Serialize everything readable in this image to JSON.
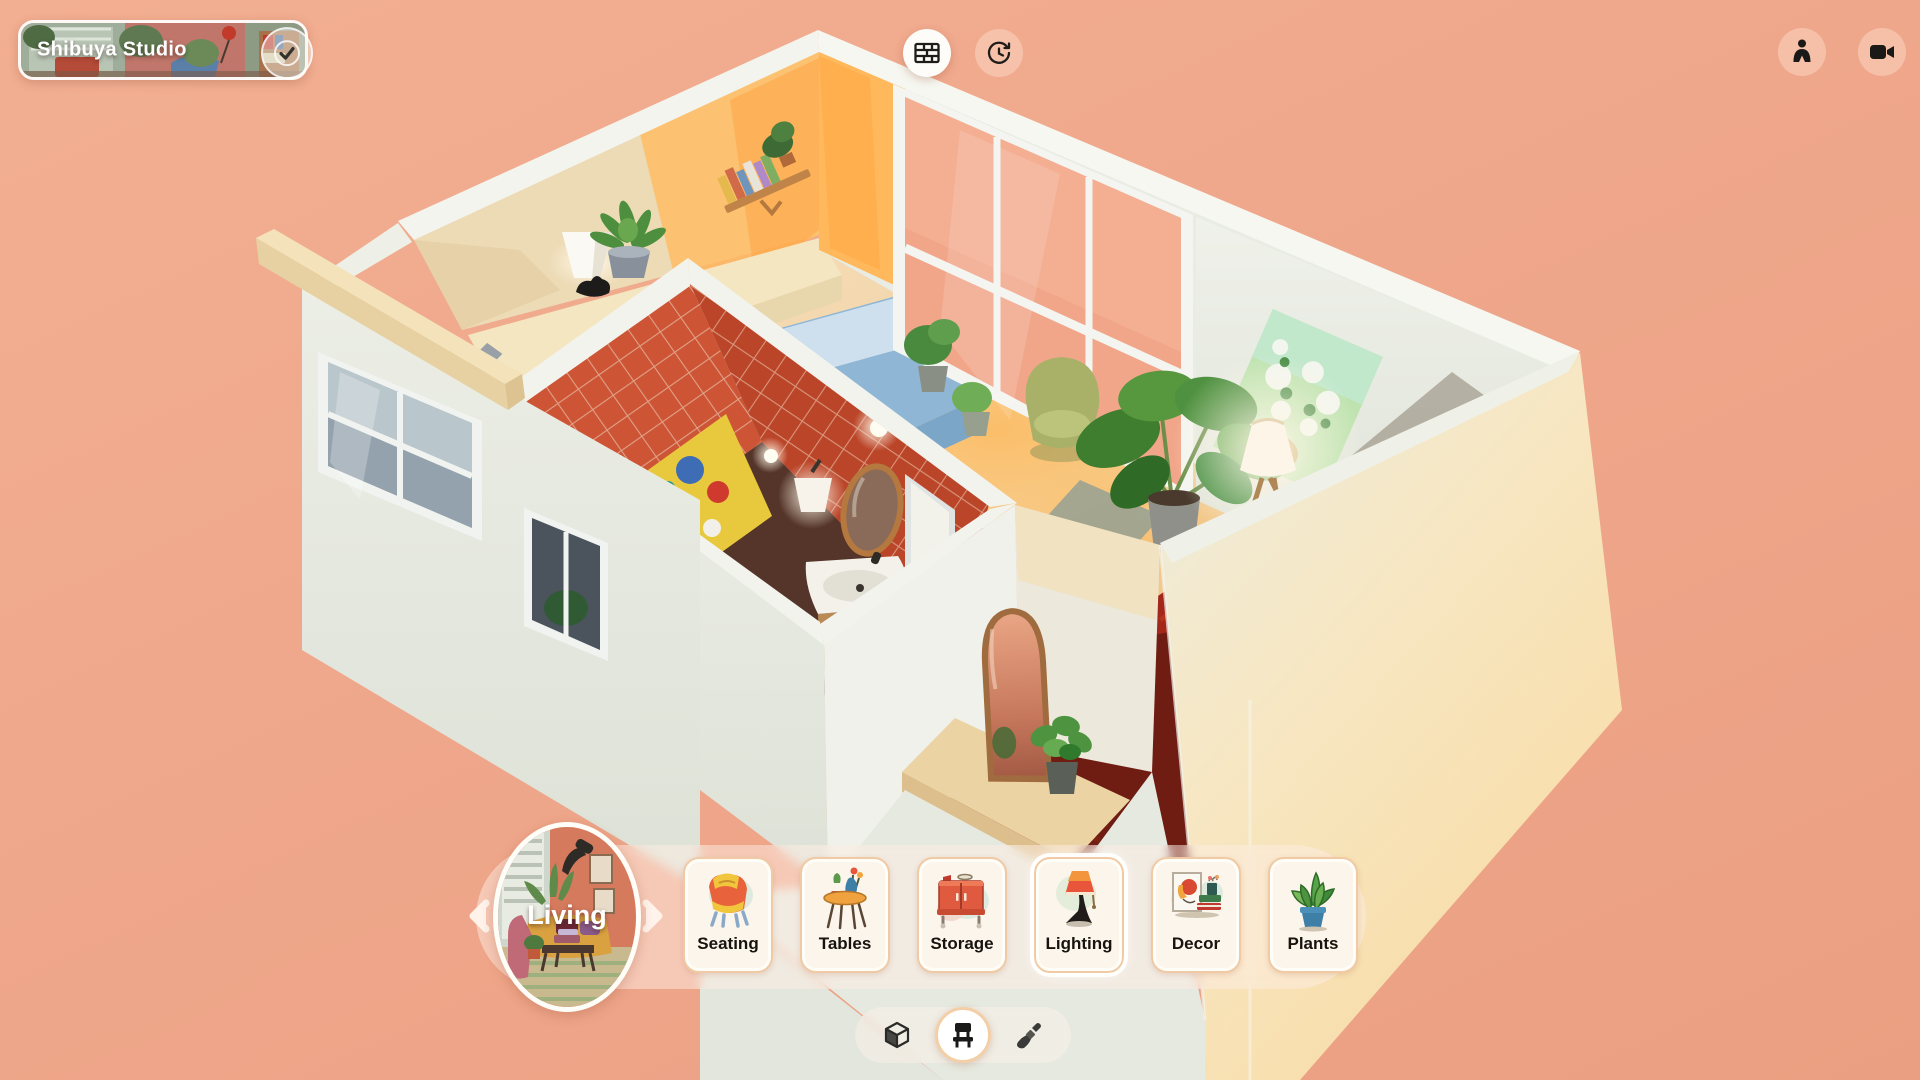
{
  "app": {
    "title": "Shibuya Studio",
    "background_color": "#efa78b"
  },
  "header": {
    "room_chip": {
      "title": "Shibuya Studio",
      "status_icon": "check-icon"
    },
    "walls_button": {
      "icon": "brick-wall-icon",
      "active": true
    },
    "history_button": {
      "icon": "history-clock-icon",
      "active": false
    },
    "person_button": {
      "icon": "person-icon"
    },
    "camera_button": {
      "icon": "video-camera-icon"
    }
  },
  "room_scene": {
    "name": "Shibuya Studio",
    "areas": [
      "bedroom",
      "bathroom",
      "living-area",
      "entry"
    ],
    "colors": {
      "floor": "#f2d6a8",
      "bathroom_tile": "#c84b30",
      "bed": "#8fb6d5",
      "rug_dark": "#6f1d12",
      "rug_red": "#a3281a",
      "walls_exterior": "#e9ebe3",
      "wood_wall": "#eddbb6",
      "sunlight": "#ffb95c",
      "window_glass": "#f1a68a"
    }
  },
  "carousel": {
    "selected_room": {
      "label": "Living"
    },
    "categories": [
      {
        "label": "Seating",
        "icon": "armchair-illustration"
      },
      {
        "label": "Tables",
        "icon": "side-table-illustration"
      },
      {
        "label": "Storage",
        "icon": "cabinet-illustration"
      },
      {
        "label": "Lighting",
        "icon": "table-lamp-illustration",
        "highlighted": true
      },
      {
        "label": "Decor",
        "icon": "frame-and-books-illustration"
      },
      {
        "label": "Plants",
        "icon": "potted-plant-illustration"
      }
    ]
  },
  "mode_bar": {
    "modes": [
      {
        "name": "build",
        "icon": "cube-icon",
        "active": false
      },
      {
        "name": "furnish",
        "icon": "chair-icon",
        "active": true
      },
      {
        "name": "paint",
        "icon": "paintbrush-icon",
        "active": false
      }
    ]
  }
}
